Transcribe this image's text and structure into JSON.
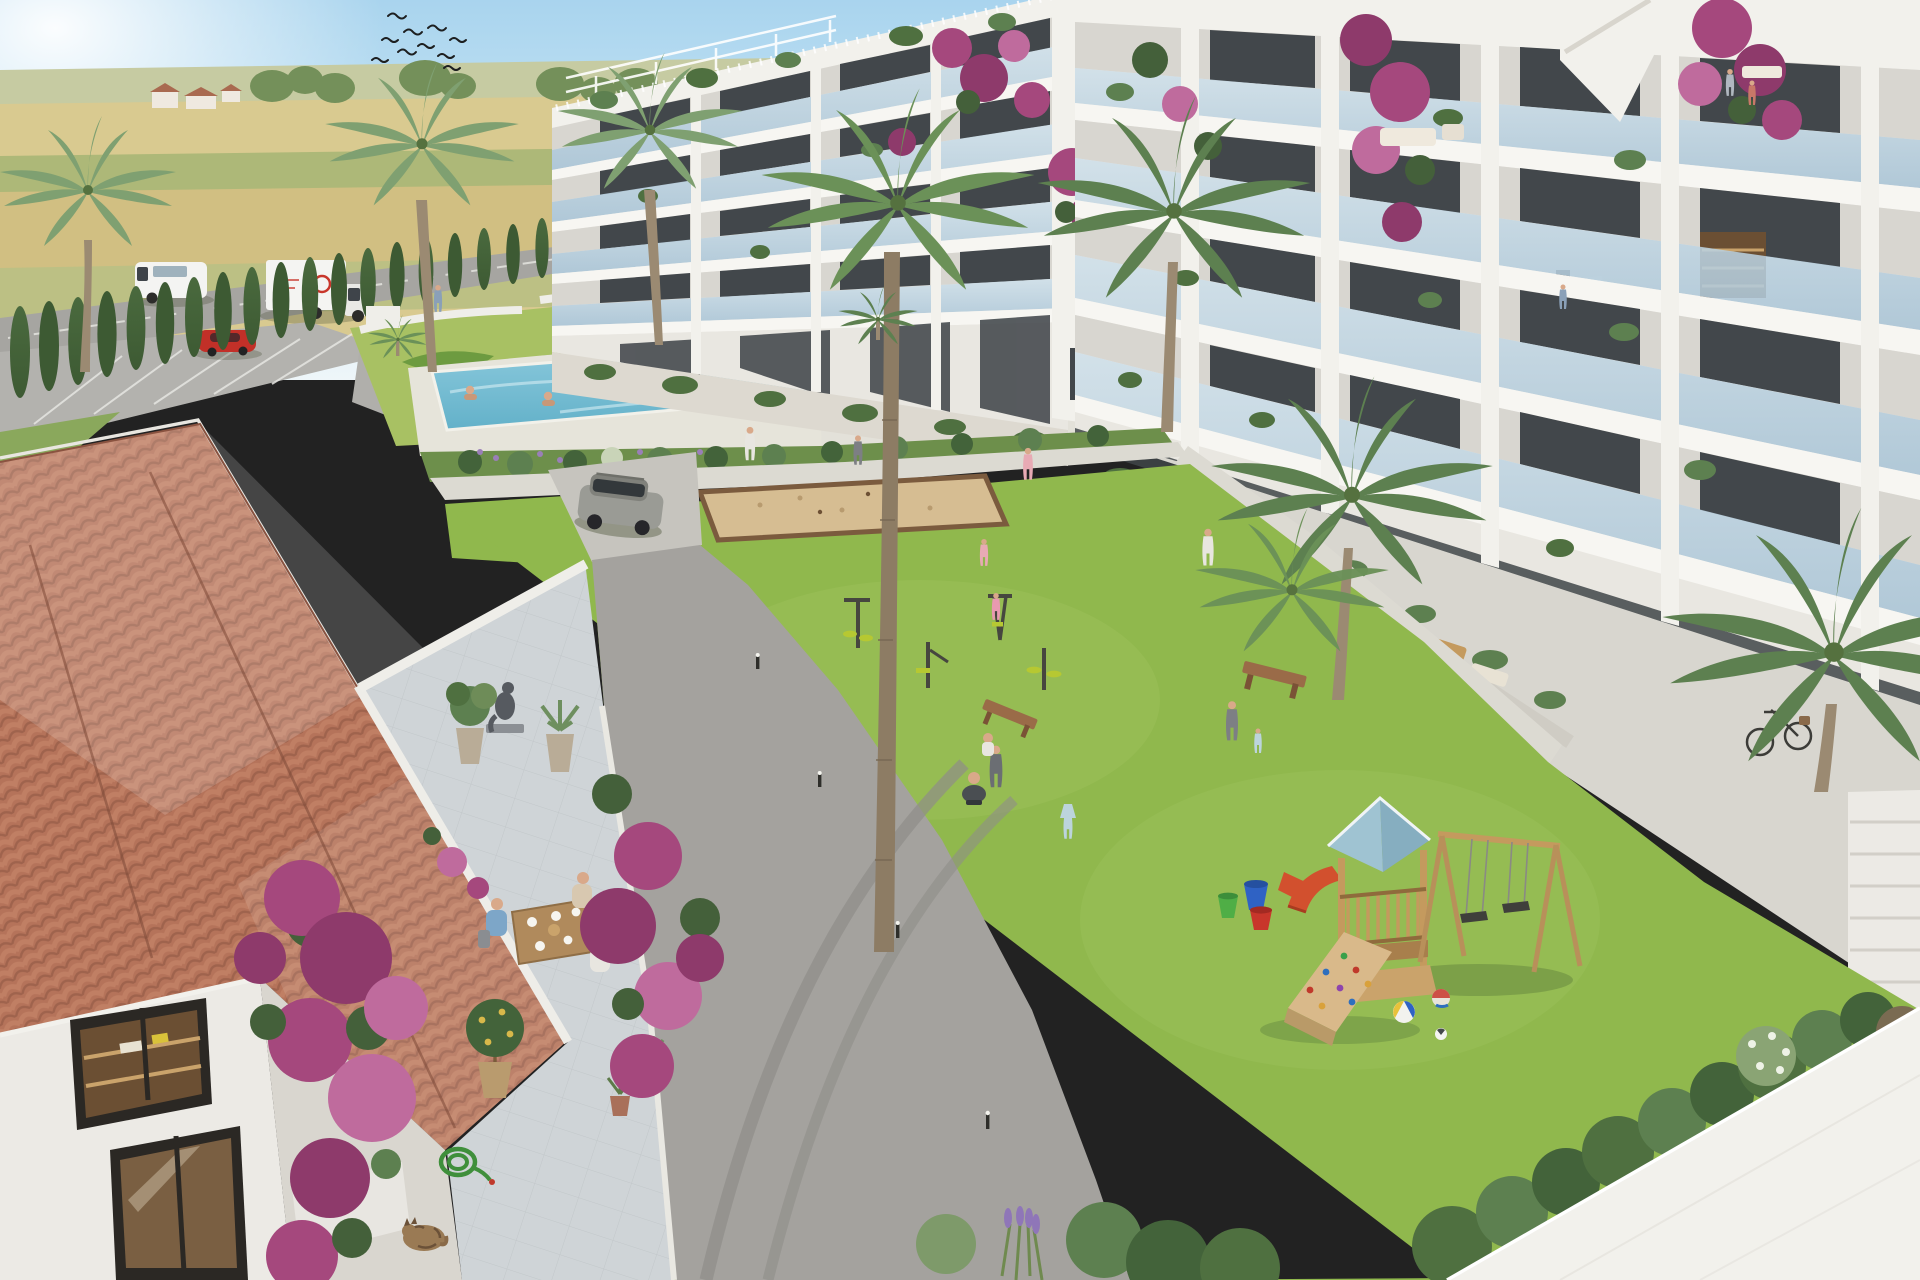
{
  "scene": {
    "type": "3d-architectural-rendering",
    "title": "Sunny aerial render of a white Mediterranean apartment complex: courtyard lawn with playground, pool and topiary garden, terracotta-roof villa in the foreground, farmland beyond",
    "sky": "clear pale blue, sun glare at top left",
    "background": "flat wheat fields with tree lines, distant farmhouses and a country road",
    "weather": "sunny"
  },
  "palette": {
    "sky_top": "#a9d4ee",
    "sky_mid": "#cde8f5",
    "sky_horizon": "#eef6f9",
    "field_far": "#c6cba2",
    "field_wheat": "#d9ca90",
    "field_green": "#adb878",
    "field_wheat2": "#d1bf82",
    "field_green2": "#bcc084",
    "tree_distant": "#74905a",
    "village_roof": "#a96a50",
    "village_wall": "#efe9e0",
    "road_bg": "#a6a5a1",
    "cypress": "#3d5a33",
    "cypress2": "#4a6a3e",
    "garden_lawn": "#a8c163",
    "topiary": "#6d9b40",
    "wall_white": "#efeee9",
    "pool_deck": "#e6e4da",
    "pool1": "#8ccadd",
    "pool2": "#63b1c9",
    "lawn": "#90b84d",
    "lawn_light": "#9cc05a",
    "path": "#dcdad2",
    "apron": "#c6c4be",
    "asphalt": "#a4a29e",
    "track": "#8f8d89",
    "sand": "#d6bd92",
    "sand_edge": "#7b5b3e",
    "bld_white": "#f2f1ec",
    "bld_face": "#e9e7e1",
    "bld_wall": "#d8d6d0",
    "slab": "#f7f6f2",
    "glass_hi": "#cfe0ea",
    "glass_lo": "#a9c4d6",
    "win": "#42474b",
    "win_warm": "#6b4f33",
    "roof_a": "#b5735a",
    "roof_b": "#c8886c",
    "roof_dark": "#8a5340",
    "roof_light": "#e3c0ad",
    "terrace": "#cfd4d7",
    "terrace_line": "#b9bec2",
    "boug1": "#a5487d",
    "boug2": "#8e3a6b",
    "boug3": "#bf6b9d",
    "leaf": "#44603a",
    "palm1": "#7fa071",
    "palm2": "#6b9158",
    "palm3": "#5d8050",
    "trunk": "#9b8a72",
    "wood": "#c49a5e",
    "wood_dark": "#8f6b3c",
    "play_roof": "#9fc3d2",
    "play_roof2": "#86aec0",
    "slide": "#d2502e",
    "equip": "#b6c832",
    "metal": "#46463f",
    "bench": "#9a6b48",
    "skin": "#d9a98a",
    "shirt_blue": "#7da6c8",
    "shirt_white": "#e8e6e0",
    "shirt_grey": "#7d7f84",
    "dress_blue": "#bcd4dc",
    "pink": "#e8aab4",
    "beige": "#d8c8b0",
    "suv": "#9a9b95",
    "red_car": "#c23028",
    "truck_white": "#f4f4f2",
    "bucket_blue": "#2f62c4",
    "bucket_red": "#c8362b",
    "bucket_green": "#4fae46",
    "cat": "#9a7a54",
    "hose": "#3f8f3b",
    "hedge_a": "#4f7040",
    "hedge_b": "#5d8050",
    "hedge_c": "#43633a",
    "lavender": "#8f76b8"
  },
  "objects": {
    "birds": {
      "label": "flock of swallows",
      "count": 10
    },
    "vehicles": [
      {
        "label": "white van driving on country road"
      },
      {
        "label": "white box truck with red logo on country road"
      },
      {
        "label": "red car parked by cypress hedge"
      },
      {
        "label": "grey SUV on courtyard drive"
      }
    ],
    "buildings": [
      {
        "label": "left apartment block, five floors, glass balconies, rooftop pergolas"
      },
      {
        "label": "right apartment block, five floors, glass balconies with plants"
      },
      {
        "label": "terracotta-tiled villa with dining terrace in foreground"
      }
    ],
    "amenities": [
      {
        "label": "swimming pool with bathers"
      },
      {
        "label": "ornamental topiary garden"
      },
      {
        "label": "petanque sand court"
      },
      {
        "label": "outdoor exercise machines",
        "count": 4
      },
      {
        "label": "wooden playground tower with blue roof, slide and double swing"
      },
      {
        "label": "wooden benches",
        "count": 2
      }
    ],
    "people": {
      "count": "about 18",
      "examples": [
        "three adults dining on the villa terrace",
        "woman in grey walking with toddler",
        "parent carrying a child",
        "girl in blue dress",
        "boy crouched by balls",
        "children at the exercise area",
        "woman walking the building path",
        "man working at a balcony desk",
        "woman standing on upper balcony",
        "two bathers in the pool"
      ]
    },
    "flora": [
      "palm trees",
      "cypress hedge row",
      "bougainvillea",
      "lavender",
      "olive trees",
      "potted citrus"
    ],
    "details": [
      "tabby cat sleeping by the terrace",
      "coiled green garden hose",
      "bicycle leaning at building corner",
      "colorful buckets and balls on the lawn",
      "curved tyre marks on the asphalt drive"
    ]
  }
}
